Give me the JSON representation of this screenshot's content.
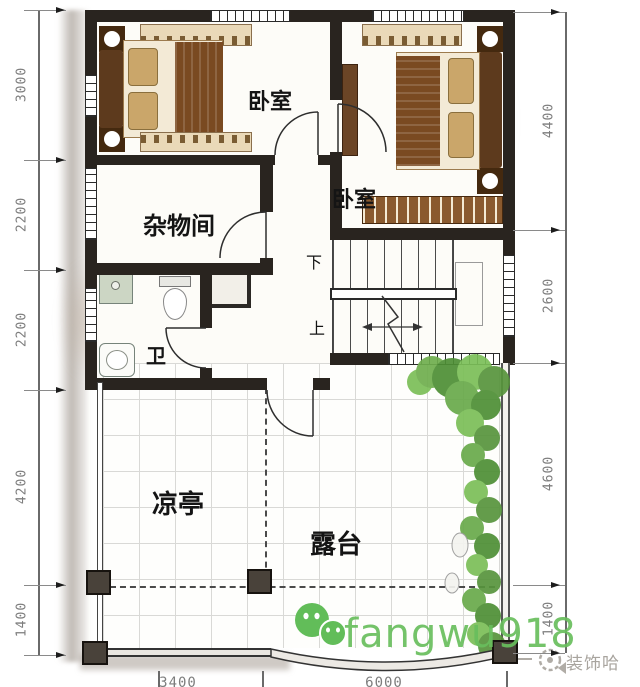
{
  "rooms": {
    "bedroom1": "卧室",
    "bedroom2": "卧室",
    "storage": "杂物间",
    "bath": "卫",
    "pavilion": "凉亭",
    "terrace": "露台"
  },
  "stairs": {
    "down": "下",
    "up": "上"
  },
  "dims": {
    "left": [
      "3000",
      "2200",
      "2200",
      "4200",
      "1400"
    ],
    "right": [
      "4400",
      "2600",
      "4600",
      "1400"
    ],
    "bottom": [
      "3400",
      "6000"
    ]
  },
  "watermark": {
    "text": "fangwu918",
    "color": "#68be5c"
  },
  "brand": {
    "text": "装饰哈",
    "color": "#a8a49e"
  },
  "colors": {
    "wall": "#29241f",
    "greenery": "#5f9e44",
    "dim_text": "#7d7d7d"
  }
}
